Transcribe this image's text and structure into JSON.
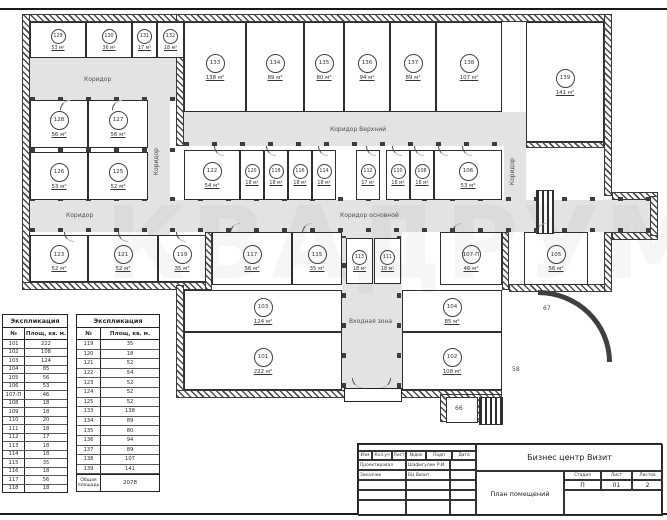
{
  "plan": {
    "rooms": [
      {
        "num": "129",
        "area": "53 м²"
      },
      {
        "num": "130",
        "area": "36 м²"
      },
      {
        "num": "131",
        "area": "17 м²"
      },
      {
        "num": "132",
        "area": "18 м²"
      },
      {
        "num": "128",
        "area": "56 м²"
      },
      {
        "num": "127",
        "area": "56 м²"
      },
      {
        "num": "126",
        "area": "53 м²"
      },
      {
        "num": "125",
        "area": "52 м²"
      },
      {
        "num": "123",
        "area": "52 м²"
      },
      {
        "num": "121",
        "area": "52 м²"
      },
      {
        "num": "119",
        "area": "35 м²"
      },
      {
        "num": "133",
        "area": "138 м²"
      },
      {
        "num": "134",
        "area": "89 м²"
      },
      {
        "num": "135",
        "area": "80 м²"
      },
      {
        "num": "136",
        "area": "94 м²"
      },
      {
        "num": "137",
        "area": "89 м²"
      },
      {
        "num": "138",
        "area": "107 м²"
      },
      {
        "num": "139",
        "area": "141 м²"
      },
      {
        "num": "122",
        "area": "54 м²"
      },
      {
        "num": "120",
        "area": "18 м²"
      },
      {
        "num": "118",
        "area": "18 м²"
      },
      {
        "num": "116",
        "area": "18 м²"
      },
      {
        "num": "114",
        "area": "18 м²"
      },
      {
        "num": "112",
        "area": "17 м²"
      },
      {
        "num": "110",
        "area": "18 м²"
      },
      {
        "num": "108",
        "area": "18 м²"
      },
      {
        "num": "106",
        "area": "53 м²"
      },
      {
        "num": "117",
        "area": "56 м²"
      },
      {
        "num": "115",
        "area": "35 м²"
      },
      {
        "num": "113",
        "area": "18 м²"
      },
      {
        "num": "111",
        "area": "18 м²"
      },
      {
        "num": "107-П",
        "area": "46 м²"
      },
      {
        "num": "105",
        "area": "56 м²"
      },
      {
        "num": "103",
        "area": "124 м²"
      },
      {
        "num": "101",
        "area": "222 м²"
      },
      {
        "num": "104",
        "area": "85 м²"
      },
      {
        "num": "102",
        "area": "108 м²"
      }
    ],
    "corridors": {
      "top_left": "Коридор",
      "left_vertical": "Коридор",
      "mid_left": "Коридор",
      "upper": "Коридор Верхний",
      "main": "Коридор основной",
      "right_vertical": "Коридор",
      "entrance": "Входная зона"
    },
    "stair_labels": [
      "66",
      "58",
      "67"
    ]
  },
  "tables": [
    {
      "title": "Экспликация",
      "headers": [
        "№",
        "Площ, кв. м."
      ],
      "rows": [
        [
          "101",
          "222"
        ],
        [
          "102",
          "108"
        ],
        [
          "103",
          "124"
        ],
        [
          "104",
          "85"
        ],
        [
          "105",
          "56"
        ],
        [
          "106",
          "53"
        ],
        [
          "107-П",
          "46"
        ],
        [
          "108",
          "18"
        ],
        [
          "109",
          "18"
        ],
        [
          "110",
          "20"
        ],
        [
          "111",
          "18"
        ],
        [
          "112",
          "17"
        ],
        [
          "113",
          "18"
        ],
        [
          "114",
          "18"
        ],
        [
          "115",
          "35"
        ],
        [
          "116",
          "18"
        ],
        [
          "117",
          "56"
        ],
        [
          "118",
          "18"
        ]
      ]
    },
    {
      "title": "Экспликация",
      "headers": [
        "№",
        "Площ, кв. м."
      ],
      "rows": [
        [
          "119",
          "35"
        ],
        [
          "120",
          "18"
        ],
        [
          "121",
          "52"
        ],
        [
          "122",
          "54"
        ],
        [
          "123",
          "52"
        ],
        [
          "124",
          "52"
        ],
        [
          "125",
          "52"
        ],
        [
          "133",
          "138"
        ],
        [
          "134",
          "89"
        ],
        [
          "135",
          "80"
        ],
        [
          "136",
          "94"
        ],
        [
          "137",
          "89"
        ],
        [
          "138",
          "107"
        ],
        [
          "139",
          "141"
        ]
      ],
      "footer": [
        "Общая площадь",
        "2078"
      ]
    }
  ],
  "title_block": {
    "project": "Бизнес центр Визит",
    "drawing": "План помещений",
    "header_cols": [
      "Изм",
      "Кол.уч",
      "Лист",
      "№док",
      "Подп",
      "Дата"
    ],
    "signature_rows": [
      [
        "Проектировал",
        "Шафигулин Р.И."
      ],
      [
        "Заказчик",
        "БЦ Визит"
      ]
    ],
    "stage_headers": [
      "Стадия",
      "Лист",
      "Листов"
    ],
    "stage_values": [
      "П",
      "01",
      "2"
    ]
  },
  "watermark": "КВАДРУМ"
}
